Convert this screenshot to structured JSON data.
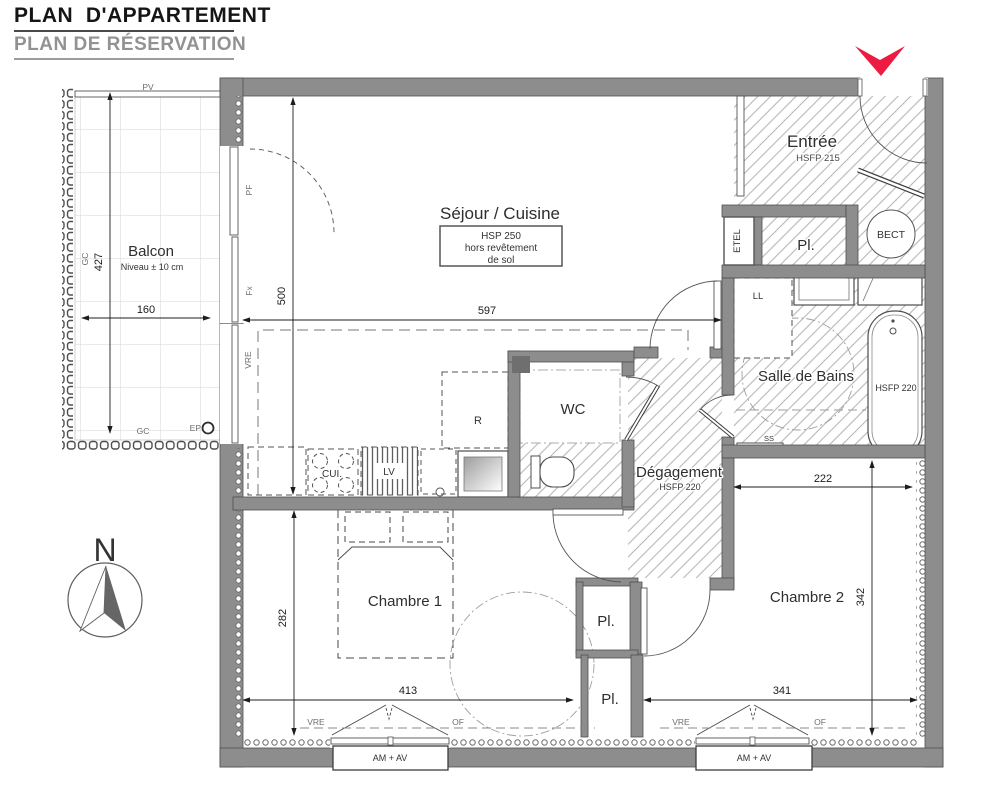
{
  "header": {
    "title": "PLAN  D'APPARTEMENT",
    "subtitle": "PLAN DE RÉSERVATION"
  },
  "accent": {
    "marker_color": "#ed1b41"
  },
  "compass": {
    "north": "N"
  },
  "rooms": {
    "balcon": {
      "label": "Balcon",
      "note": "Niveau ± 10 cm"
    },
    "sejour": {
      "label": "Séjour / Cuisine",
      "hsp1": "HSP 250",
      "hsp2": "hors revêtement",
      "hsp3": "de sol"
    },
    "entree": {
      "label": "Entrée",
      "hsfp": "HSFP 215"
    },
    "wc": {
      "label": "WC"
    },
    "degagement": {
      "label": "Dégagement",
      "hsfp": "HSFP 220"
    },
    "salle_de_bains": {
      "label": "Salle de Bains",
      "hsfp": "HSFP 220"
    },
    "chambre1": {
      "label": "Chambre 1"
    },
    "chambre2": {
      "label": "Chambre 2"
    },
    "placard_entree": {
      "label": "Pl."
    },
    "placard1": {
      "label": "Pl."
    },
    "placard2": {
      "label": "Pl."
    }
  },
  "fixtures": {
    "etel": "ETEL",
    "bect": "BECT",
    "ll": "LL",
    "lv": "LV",
    "cui": "CUI.",
    "fridge": "R",
    "ss": "SS",
    "ep": "EP"
  },
  "dims": {
    "balcon_h": "427",
    "balcon_w": "160",
    "sejour_w": "597",
    "sejour_h": "500",
    "sdb_w": "222",
    "ch1_h": "282",
    "ch1_w": "413",
    "ch2_h": "342",
    "ch2_w": "341"
  },
  "openings": {
    "pv": "PV",
    "pf": "PF",
    "fx": "Fx",
    "vre_sejour": "VRE",
    "vre_ch1": "VRE",
    "of_ch1": "OF",
    "vre_ch2": "VRE",
    "of_ch2": "OF",
    "gc_left": "GC",
    "gc_bottom": "GC",
    "am_av_1": "AM + AV",
    "am_av_2": "AM + AV"
  }
}
